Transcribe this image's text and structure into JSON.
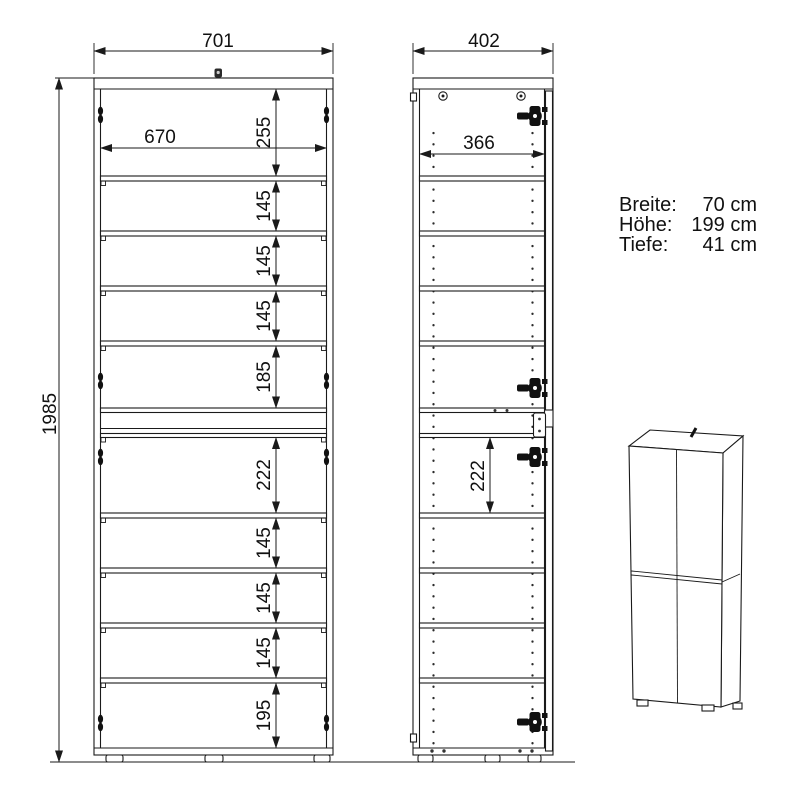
{
  "drawing": {
    "front_view": {
      "width_mm": "701",
      "inner_width_mm": "670",
      "height_mm": "1985",
      "section_heights_mm": [
        "255",
        "145",
        "145",
        "145",
        "185",
        "222",
        "145",
        "145",
        "145",
        "195"
      ]
    },
    "side_view": {
      "depth_mm": "402",
      "inner_depth_mm": "366",
      "section_height_mm": "222"
    },
    "specs": {
      "rows": [
        {
          "label": "Breite:",
          "value": "70 cm"
        },
        {
          "label": "Höhe:",
          "value": "199 cm"
        },
        {
          "label": "Tiefe:",
          "value": "41 cm"
        }
      ]
    },
    "icons": {
      "hinge": "concealed-cup-hinge",
      "screw": "screw-head",
      "pin_holes": "shelf-pin-hole-columns"
    },
    "colors": {
      "line": "#1a1a1a",
      "background": "#ffffff"
    }
  }
}
